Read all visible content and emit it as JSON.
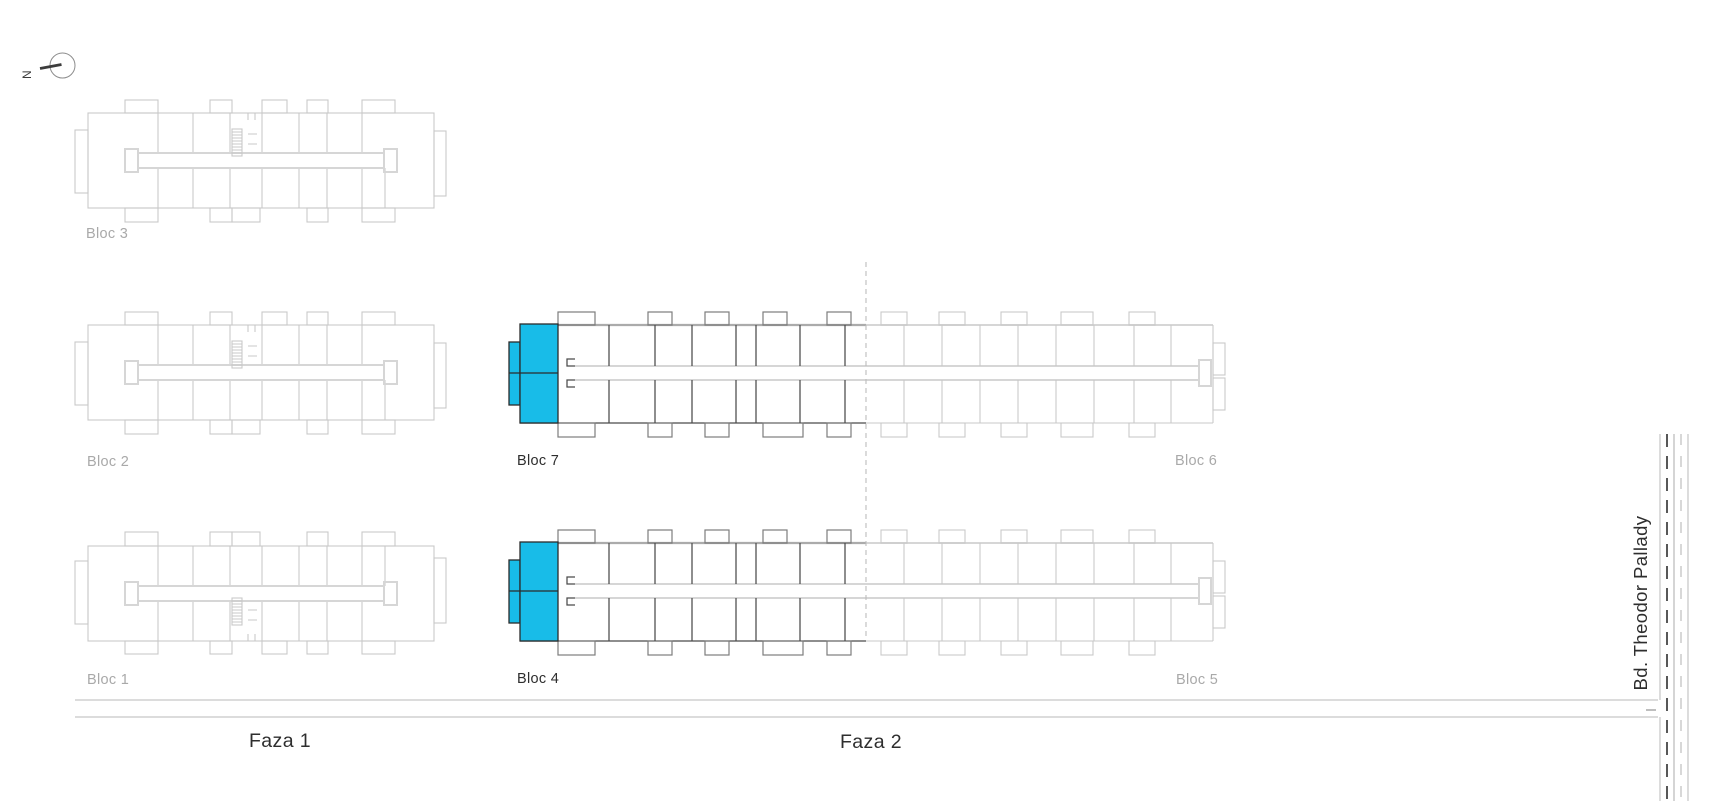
{
  "compass": {
    "north_label": "N"
  },
  "blocks": {
    "bloc1": {
      "label": "Bloc 1"
    },
    "bloc2": {
      "label": "Bloc 2"
    },
    "bloc3": {
      "label": "Bloc 3"
    },
    "bloc4": {
      "label": "Bloc 4"
    },
    "bloc5": {
      "label": "Bloc 5"
    },
    "bloc6": {
      "label": "Bloc 6"
    },
    "bloc7": {
      "label": "Bloc 7"
    }
  },
  "phases": {
    "faza1": {
      "label": "Faza 1"
    },
    "faza2": {
      "label": "Faza 2"
    }
  },
  "street": {
    "label": "Bd. Theodor Pallady"
  },
  "colors": {
    "highlight_unit": "#18bce8",
    "inactive_line": "#c9c9c9",
    "active_line": "#4b4b4b",
    "muted_text": "#a9a9a9",
    "dark_text": "#2e2e2e"
  }
}
